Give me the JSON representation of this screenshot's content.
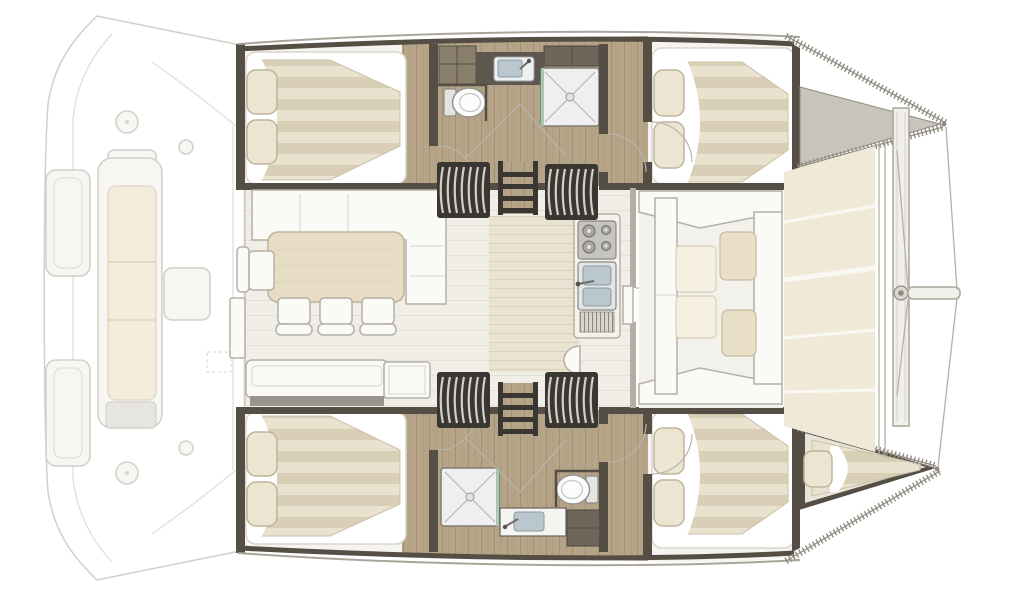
{
  "visible_text": [],
  "floor_plan": {
    "vessel": "sailing catamaran",
    "view": "overhead interior layout plan",
    "orientation": "bow to the right, stern to the left",
    "port_hull": {
      "aft_cabin": {
        "berth": "double",
        "pillows": 2
      },
      "bathroom": {
        "fixtures": [
          "washbasin counter",
          "toilet",
          "shower cubicle"
        ]
      },
      "forward_cabin": {
        "berth": "double",
        "pillows": 2
      },
      "bow": "foredeck / anchor locker"
    },
    "starboard_hull": {
      "aft_cabin": {
        "berth": "double",
        "pillows": 2
      },
      "bathroom": {
        "fixtures": [
          "shower cubicle",
          "washbasin counter",
          "toilet"
        ]
      },
      "forward_cabin": {
        "berth": "double",
        "pillows": 2
      },
      "bow": "forepeak berth with pillow"
    },
    "saloon": {
      "furniture": [
        "L-shaped sofa",
        "dining table",
        "three chairs",
        "side chair",
        "aft bench",
        "cabinet"
      ],
      "galley": [
        "gas stove",
        "double sink",
        "counter",
        "vent grill"
      ],
      "companionways": {
        "stair_flights": 4,
        "ladders": 2
      },
      "mast_step": 1
    },
    "aft_cockpit": {
      "style": "faded ghosted linework",
      "items": [
        "long bench seat with cushions",
        "cockpit table",
        "two transom platforms",
        "winches"
      ]
    },
    "foredeck": {
      "items": [
        "forward cockpit with table and cushions",
        "trampoline",
        "forward crossbeam",
        "bowsprit",
        "forestay lines"
      ]
    }
  },
  "colors": {
    "background": "#ffffff",
    "hull_wall": "#544e45",
    "stair_block": "#3a3631",
    "stair_slat": "#d2cfc9",
    "wood_floor": "#b5a487",
    "wood_plank_line": "#a29070",
    "locker_wood_dark": "#6e665a",
    "locker_wood": "#8a7f6c",
    "mattress_light": "#e9e2cf",
    "mattress_dark": "#d9cfb6",
    "pillow": "#ece5d2",
    "pillow_edge": "#bfb49a",
    "bed_base": "#ffffff",
    "cabin_base": "#f6f4f0",
    "saloon_floor": "#f1eee7",
    "saloon_plank_line": "#e4e0d6",
    "corridor_floor": "#ebe3d2",
    "corridor_plank_line": "#dbd0bc",
    "furniture_white": "#fafaf7",
    "furniture_stroke": "#b4b0a6",
    "table": "#e6ddc4",
    "table_stroke": "#beb49a",
    "cushion_beige": "#e8dfc6",
    "cushion_pale": "#f6f0e2",
    "bow_deck": "#c8c4bb",
    "trampoline": "#f0e9d8",
    "trampoline_seam": "#faf8f2",
    "shower": "#eef0f0",
    "shower_glass": "#a8c8b6",
    "fixture_stroke": "#8d8a84",
    "sink_basin": "#bac7cf",
    "counter_dark": "#5d574d",
    "gunwale_tick": "#8f8b80",
    "faded_stroke": "#d2cfc8",
    "faded_fill": "#f7f6f3",
    "faded_cushion": "#f3ecda",
    "edge_line": "#a9a59b"
  }
}
